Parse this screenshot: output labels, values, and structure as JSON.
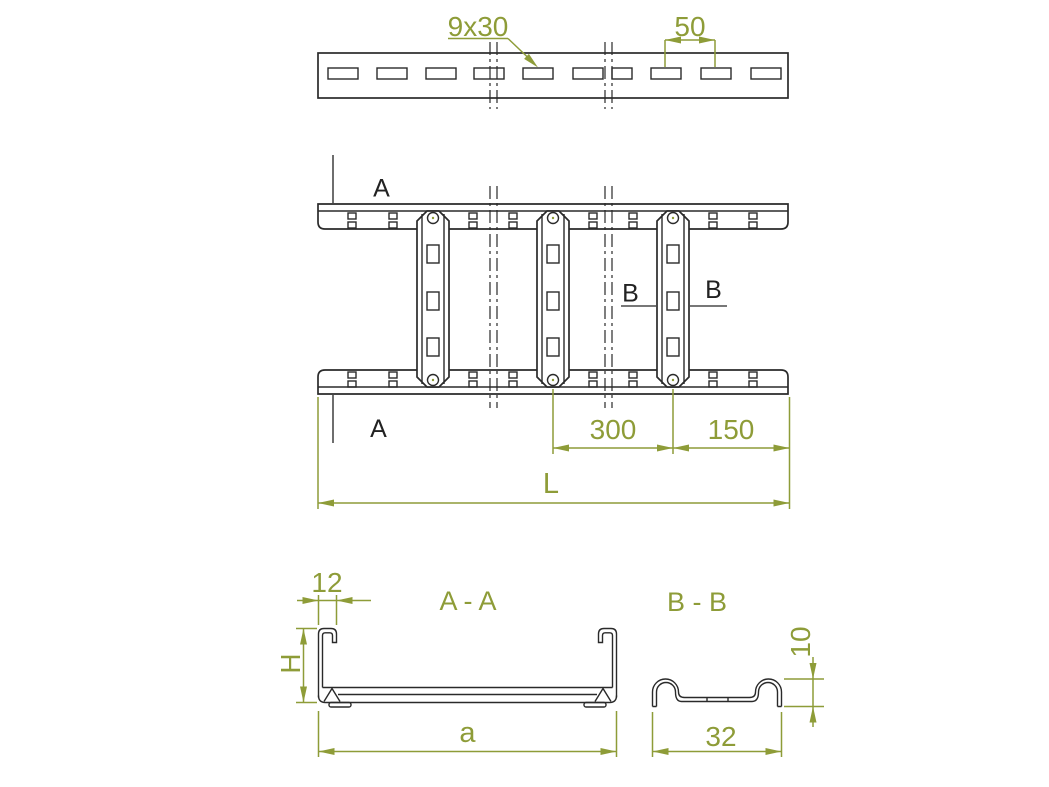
{
  "drawing": {
    "type": "technical-drawing-cable-ladder",
    "colors": {
      "background": "#ffffff",
      "line": "#2a2a2a",
      "dimension": "#8e9c38",
      "section_line": "#4a4a4a"
    },
    "top_view": {
      "slot_size_label": "9x30",
      "slot_pitch_label": "50"
    },
    "plan_view": {
      "section_a_top": "A",
      "section_a_bottom": "A",
      "section_b_left": "B",
      "section_b_right": "B",
      "dim_rung_spacing": "300",
      "dim_end_offset": "150",
      "dim_total_length": "L"
    },
    "section_aa": {
      "title": "A - A",
      "dim_flange_width": "12",
      "dim_height": "H",
      "dim_inner_width": "a"
    },
    "section_bb": {
      "title": "B - B",
      "dim_hump_height": "10",
      "dim_width": "32"
    }
  }
}
